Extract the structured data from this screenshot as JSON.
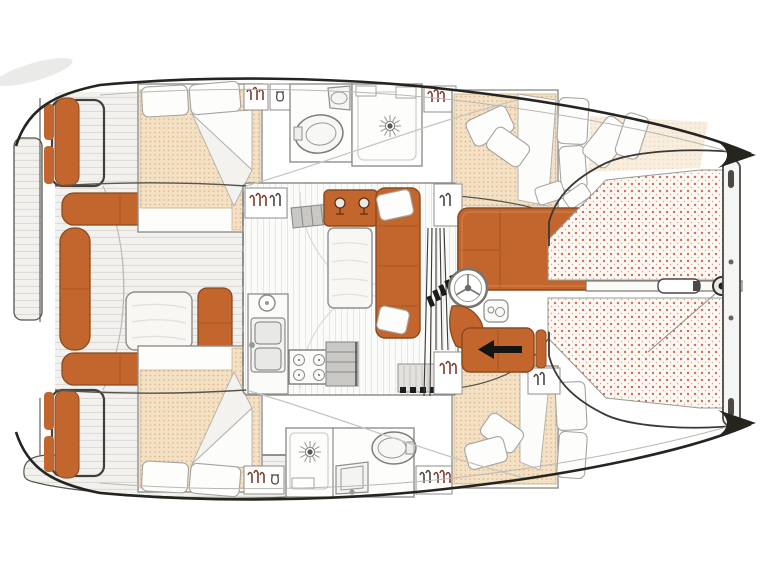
{
  "title": "Catamaran interior layout plan (top-down)",
  "colors": {
    "background": "#ffffff",
    "hull_outline": "#26241f",
    "inner_line": "#55544f",
    "wall": "#8f8e8b",
    "upholstery": "#c2662d",
    "upholstery_dark": "#8a4a1f",
    "mattress": "#f4e0c3",
    "mattress_dot": "#d9b38c",
    "trampoline_bg": "#fcf8f3",
    "trampoline_dot": "#d1705a",
    "cushion": "#fdfdfc",
    "cushion_edge": "#a5a4a0",
    "deck_fill": "#f2f1ee",
    "deck_line": "#dbd9d5",
    "floor_fill": "#fbfbf9",
    "floor_line": "#e9e7e2",
    "steps_gray": "#c9c8c5",
    "hardware_black": "#1c1c1a",
    "glyph_red": "#7c3a2c",
    "glyph_dark": "#474641",
    "table_wood": "#f8f7f4"
  },
  "features": [
    "aft-swim-platforms",
    "transom-seats",
    "teak-aft-deck",
    "cockpit-benches",
    "cockpit-table",
    "aft-cabin-berths",
    "hull-bathrooms",
    "shower-sun-drains",
    "wardrobes-with-hangers",
    "saloon-l-sofa",
    "saloon-table",
    "galley-double-sink",
    "galley-stove",
    "companionway-steps",
    "forward-cabin-berths",
    "deck-cushions",
    "forward-sunpad",
    "helm-wheel",
    "helm-seat",
    "line-clutches",
    "companionway-arrow",
    "bow-trampolines",
    "centerline-bowsprit",
    "forward-crossbeam"
  ]
}
